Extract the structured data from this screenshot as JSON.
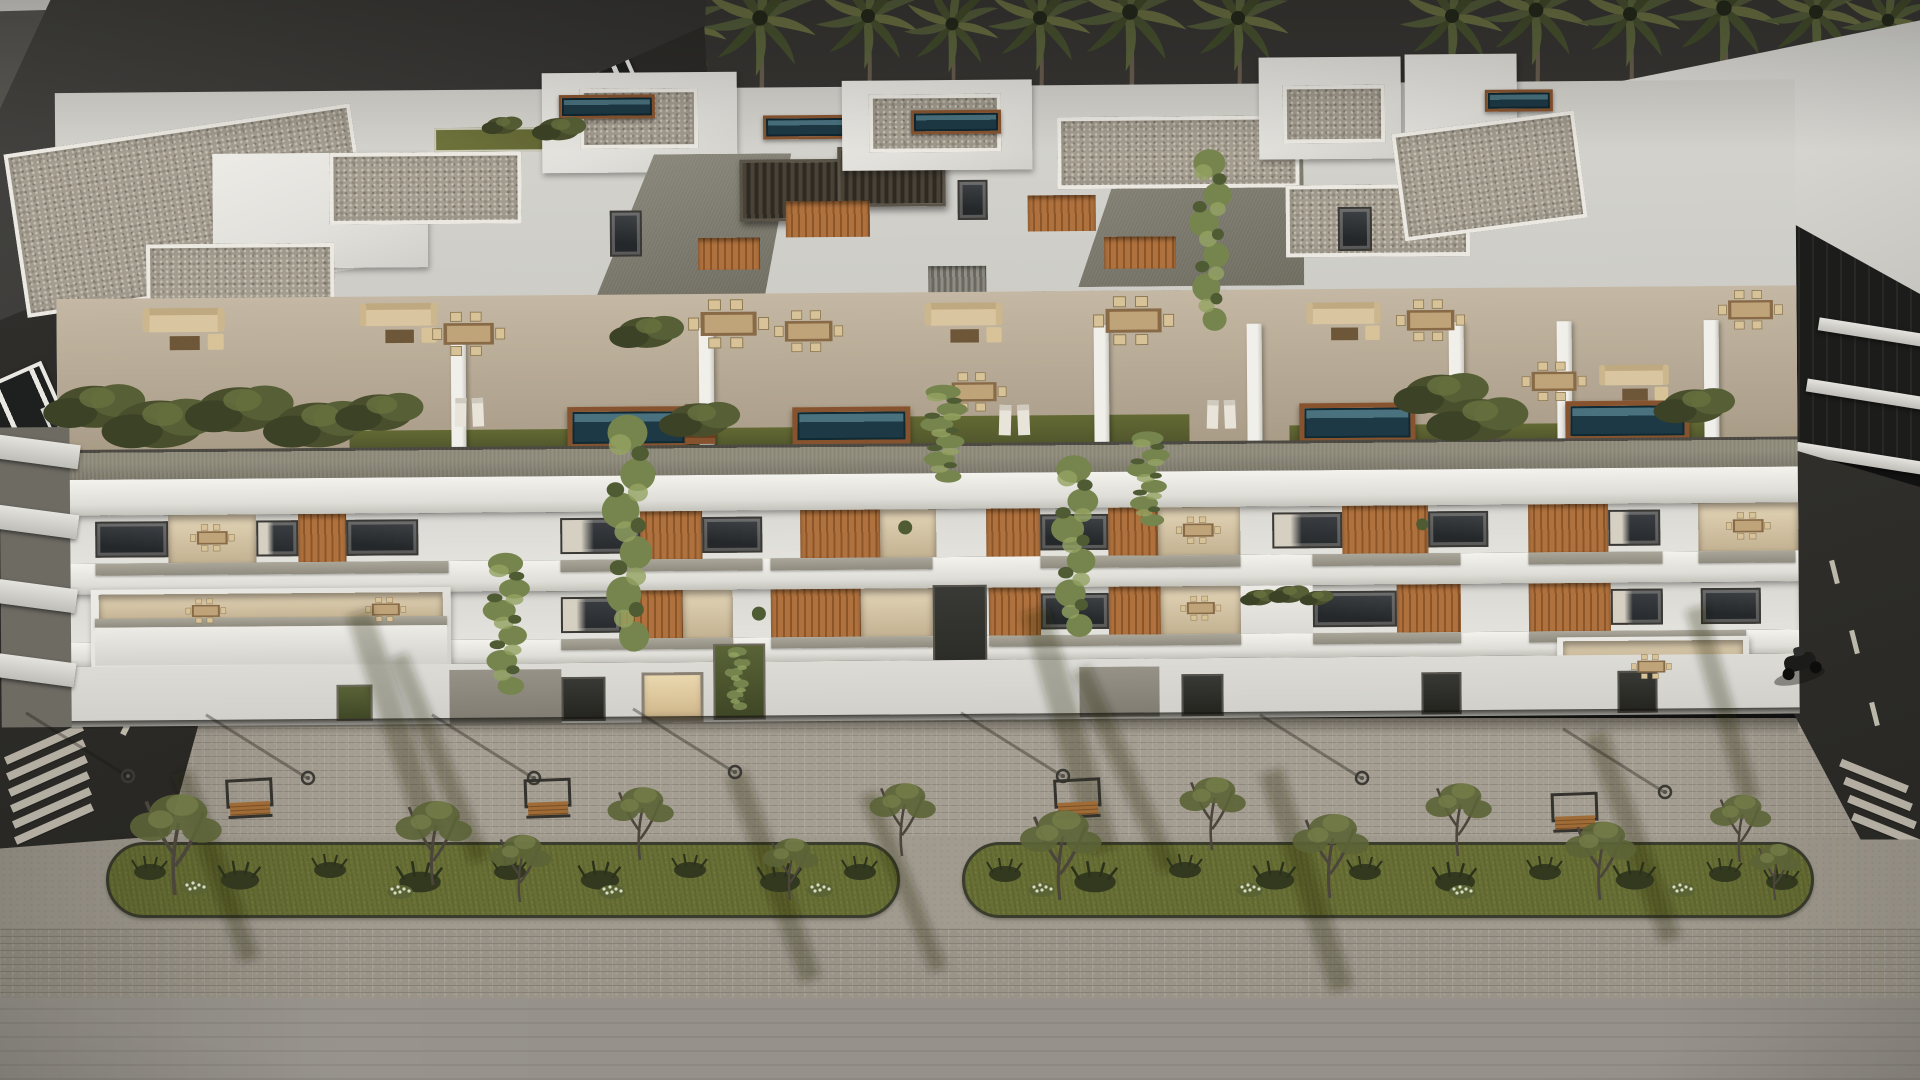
{
  "meta": {
    "type": "architectural-render",
    "view": "aerial-dusk",
    "canvas": {
      "width": 1920,
      "height": 1080
    }
  },
  "scene": {
    "labels": {
      "stage": "Aerial dusk rendering of a modern white apartment complex with rooftop pools, terraces and a landscaped boulevard",
      "sky": "dark evening sky",
      "palms": "row of palm trees along the skyline",
      "left_building": "dark neighbouring apartment block with white window frames",
      "right_building": "white neighbouring building with dark glass bands",
      "main_building": "main white residential building",
      "rooftop": "penthouse level with gravel roofs, pergolas and plunge pools",
      "terrace": "communal terrace level with outdoor furniture, hedges and pools",
      "floors": "two residential floors with wood-slat balconies and vertical gardens",
      "ground_floor": "ground floor with recessed entrances",
      "boulevard": "paved pedestrian boulevard with benches, trees and street lights",
      "median_left": "left planted median strip",
      "median_right": "right planted median strip",
      "left_road": "asphalt road with lane markings and crosswalk",
      "right_road": "asphalt road with lane markings and crosswalk",
      "bench": "wooden street bench",
      "street_light": "street light",
      "street_tree": "young street tree",
      "palm": "palm tree",
      "scooter": "parked scooter",
      "pool": "plunge pool",
      "vine": "vertical garden vine"
    },
    "counts": {
      "palm_trees": 16,
      "rooftop_pools": 4,
      "terrace_pools": 4,
      "benches": 4,
      "street_lights": 7,
      "median_strips": 2,
      "street_trees": 13,
      "residential_floors_visible": 3,
      "scooters": 1
    },
    "palette": {
      "sky": "#343230",
      "white_hi": "#eceae5",
      "white": "#e0dfda",
      "white_lo": "#cfcec8",
      "wall": "#d8d7d1",
      "parapet": "#837f70",
      "parapet_dark": "#504e45",
      "terrace": "#b5a892",
      "gravel_base": "#a39c8e",
      "grass_roof": "#6b7036",
      "pool_deep": "#1d3a47",
      "pool_lite": "#47727f",
      "deck": "#8a532c",
      "wood": "#b2713a",
      "wood_dark": "#8f5627",
      "glass": "#26292b",
      "curtain": "#d6cfc0",
      "interior": "#c2b190",
      "vine": "#75854a",
      "hedge": "#49502c",
      "pave": "#a49d90",
      "road_smooth": "#96928a",
      "asphalt": "#282724",
      "marking": "#d6d0c0",
      "grass": "#687031",
      "bush": "#333a1f",
      "flower": "#d7dac4",
      "bench_wood": "#a26b33",
      "iron": "#35332e",
      "trunk": "#6a5e4f"
    }
  }
}
